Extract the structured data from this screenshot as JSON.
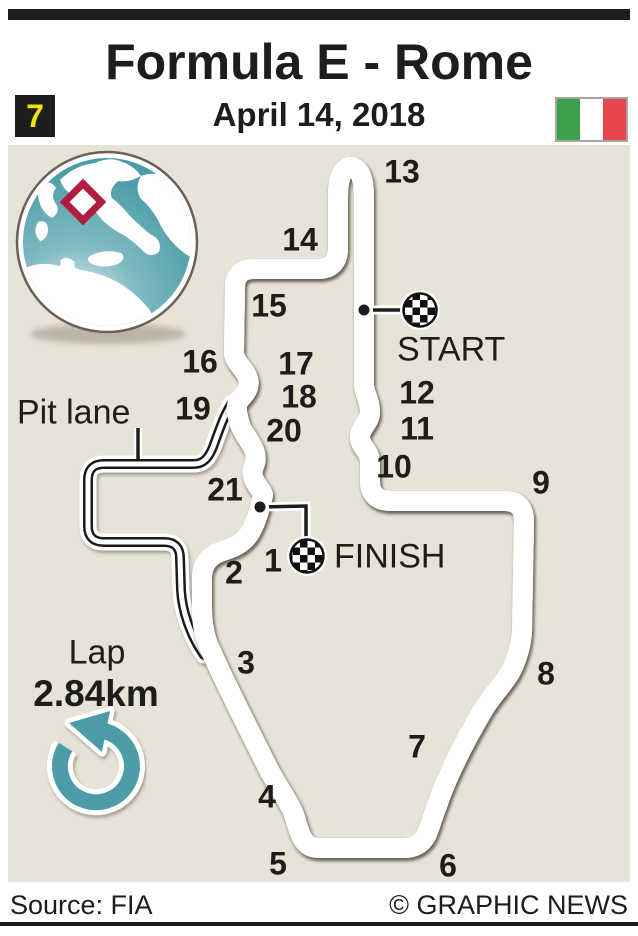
{
  "header": {
    "race_number": "7",
    "title": "Formula E - Rome",
    "date": "April 14, 2018",
    "flag": "italy-flag"
  },
  "map": {
    "start_label": "START",
    "finish_label": "FINISH",
    "pit_lane_label": "Pit lane",
    "lap_label": "Lap",
    "lap_distance": "2.84km",
    "direction": "anticlockwise",
    "turns": [
      "1",
      "2",
      "3",
      "4",
      "5",
      "6",
      "7",
      "8",
      "9",
      "10",
      "11",
      "12",
      "13",
      "14",
      "15",
      "16",
      "17",
      "18",
      "19",
      "20",
      "21"
    ]
  },
  "footer": {
    "source": "Source: FIA",
    "credit": "© GRAPHIC NEWS"
  },
  "colors": {
    "track_yellow": "#F9E700",
    "track_black": "#1A1A1A",
    "teal": "#4C9DA8",
    "map_background": "#E7E3D6",
    "marker_red": "#B01D41",
    "flag_green": "#3DA14C",
    "flag_red": "#E8454F"
  }
}
